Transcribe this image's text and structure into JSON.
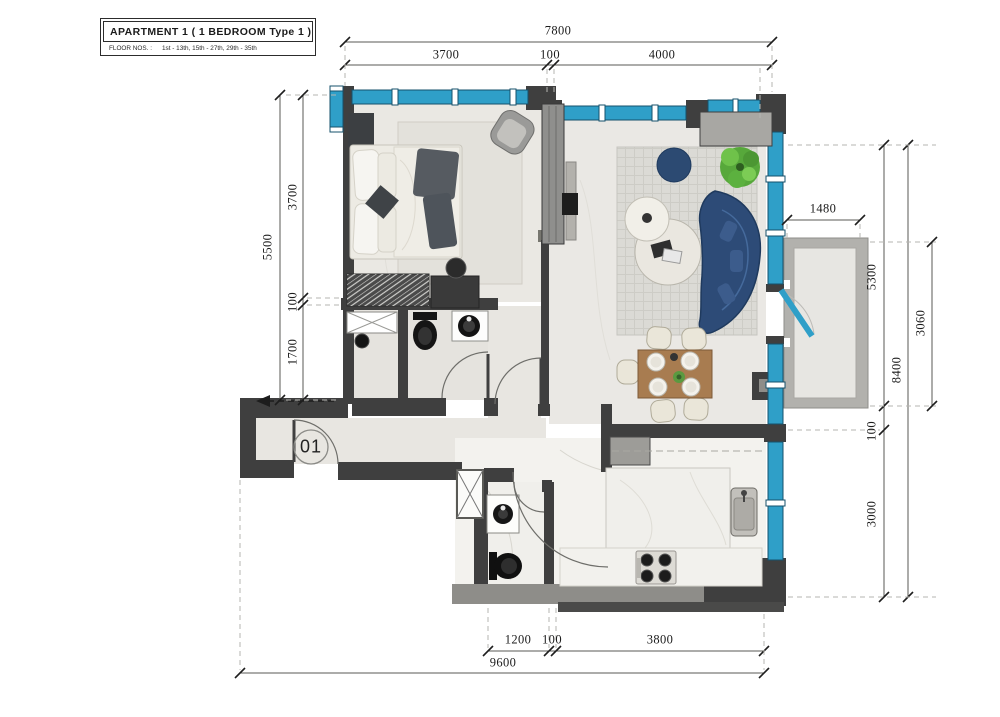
{
  "title_block": {
    "title": "APARTMENT  1  ( 1 BEDROOM Type 1 )",
    "floors_label": "FLOOR NOS. :",
    "floors_value": "1st - 13th, 15th - 27th, 29th - 35th"
  },
  "unit_number": "01",
  "dimensions": {
    "top": {
      "total": "7800",
      "segments": [
        "3700",
        "100",
        "4000"
      ]
    },
    "left": {
      "total": "5500",
      "segments": [
        "3700",
        "100",
        "1700"
      ]
    },
    "right": {
      "balcony_width": "1480",
      "segments": [
        "5300",
        "100",
        "3000"
      ],
      "total": "8400",
      "balcony_depth": "3060"
    },
    "bottom": {
      "segments": [
        "1200",
        "100",
        "3800"
      ],
      "total": "9600"
    }
  },
  "colors": {
    "wall": "#3f3f3f",
    "window": "#2f9fc8",
    "sofa": "#2d4b77",
    "plant": "#5cb53e",
    "table_wood": "#a87c50",
    "balcony_wall": "#b2b1ad"
  }
}
